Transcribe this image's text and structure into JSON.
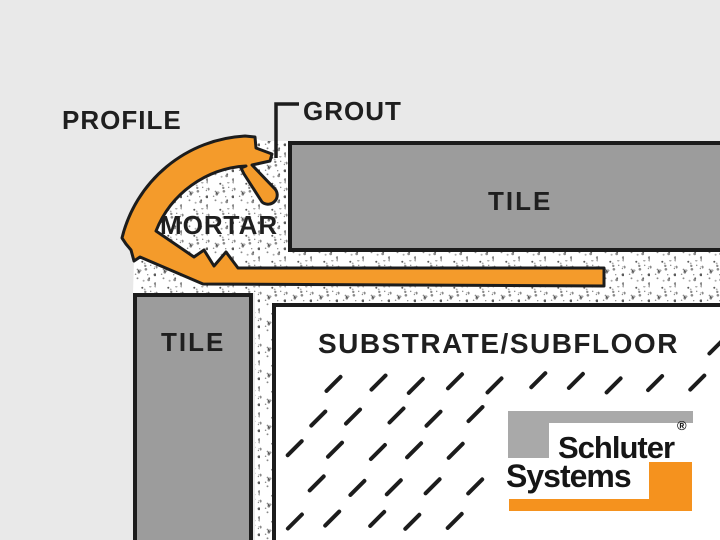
{
  "diagram": {
    "title_labels": {
      "profile": "PROFILE",
      "grout": "GROUT",
      "mortar": "MORTAR",
      "tile_top": "TILE",
      "tile_left": "TILE",
      "substrate": "SUBSTRATE/SUBFLOOR"
    },
    "logo": {
      "line1": "Schluter",
      "line2": "Systems",
      "registered_mark": "®"
    },
    "colors": {
      "background": "#E9E9E9",
      "profile_orange": "#F49B2B",
      "logo_orange": "#F5921E",
      "tile_gray": "#9C9C9C",
      "logo_gray": "#A9A9A9",
      "outline_black": "#1C1C1C",
      "mortar_white": "#FFFFFF",
      "stipple_dot_dark": "#5A5A5A",
      "stipple_dot_mid": "#8A8A8A",
      "stipple_dot_light": "#ADADAD",
      "label_text": "#1F1F1F"
    }
  }
}
